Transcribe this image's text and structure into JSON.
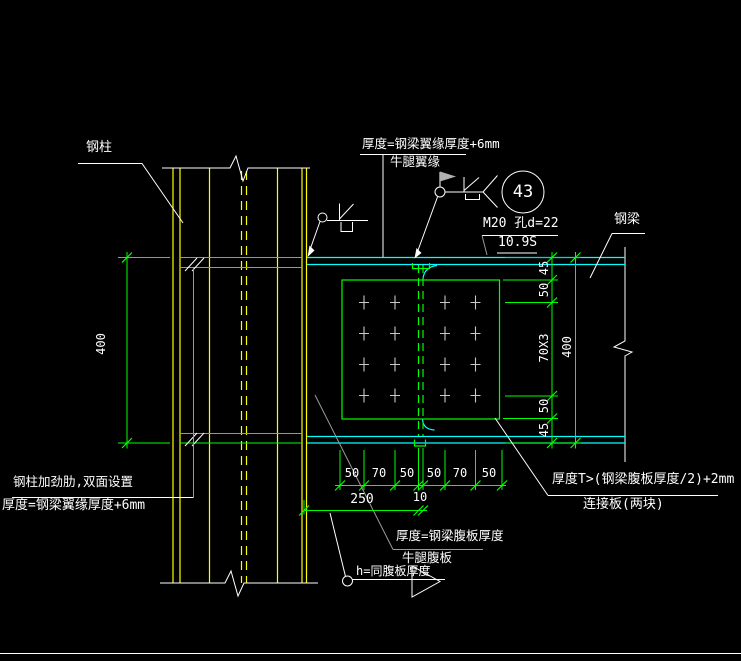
{
  "colors": {
    "background": "#000000",
    "column_lines": "#ffff00",
    "beam_flange_lines": "#00ffff",
    "plate_and_dimensions": "#00ff00",
    "annotations": "#ffffff",
    "gray_leaders": "#9a9a9a",
    "bolts": "#c8c8c8"
  },
  "labels": {
    "steel_column": "钢柱",
    "steel_beam": "钢梁",
    "corbel_flange_note_line1": "厚度=钢梁翼缘厚度+6mm",
    "corbel_flange_note_line2": "牛腿翼缘",
    "bolt_spec": "M20 孔d=22",
    "bolt_grade": "10.9S",
    "detail_number": "43",
    "column_stiffener_note_line1": "钢柱加劲肋,双面设置",
    "column_stiffener_note_line2": "厚度=钢梁翼缘厚度+6mm",
    "corbel_web_note_line1": "厚度=钢梁腹板厚度",
    "corbel_web_note_line2": "牛腿腹板",
    "weld_size_note": "h=同腹板厚度",
    "splice_plate_note_line1": "厚度T>(钢梁腹板厚度/2)+2mm",
    "splice_plate_note_line2": "连接板(两块)"
  },
  "dimensions": {
    "beam_depth_left": "400",
    "beam_depth_right": "400",
    "right_chain": [
      "45",
      "50",
      "70X3",
      "50",
      "45"
    ],
    "bottom_chain": [
      "50",
      "70",
      "50",
      "50",
      "70",
      "50"
    ],
    "corbel_length": "250",
    "splice_gap": "10"
  }
}
